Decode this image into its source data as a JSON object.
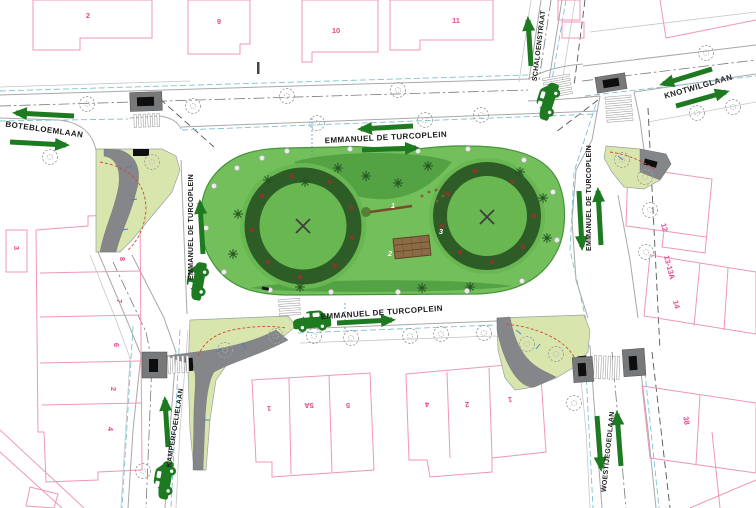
{
  "streets": {
    "botebloemlaan": "BOTEBLOEMLAAN",
    "schaloenstraat": "SCHALOENSTRAAT",
    "knotwilglaan": "KNOTWILGLAAN",
    "kamperfoelielaan": "KAMPERFOELIELAAN",
    "woestijegoedlaan": "WOESTIJEGOEDLAAN",
    "turcoplein": "EMMANUEL DE TURCOPLEIN"
  },
  "building_numbers": [
    "2",
    "9",
    "10",
    "11",
    "3",
    "8",
    "7",
    "6",
    "2",
    "4",
    "1",
    "5A",
    "5",
    "4",
    "2",
    "1",
    "12",
    "13-13A",
    "14",
    "38"
  ],
  "park_markers": [
    "1",
    "2",
    "3"
  ],
  "icons": {
    "car": "car-icon",
    "tree": "tree-icon",
    "direction_arrow": "direction-arrow-icon"
  },
  "colors": {
    "arrow_green": "#1e7a21",
    "park_green": "#72bf5b",
    "shrub_ring_green": "#2d5c27",
    "island_green": "#d8e6ad",
    "pavement_gray": "#77787a",
    "parcel_pink": "#f096b4",
    "house_number_pink": "#e8488c",
    "curb_cyan": "#7cc3d4",
    "deck_brown": "#8a6b46",
    "guide_red": "#cf4a33"
  }
}
